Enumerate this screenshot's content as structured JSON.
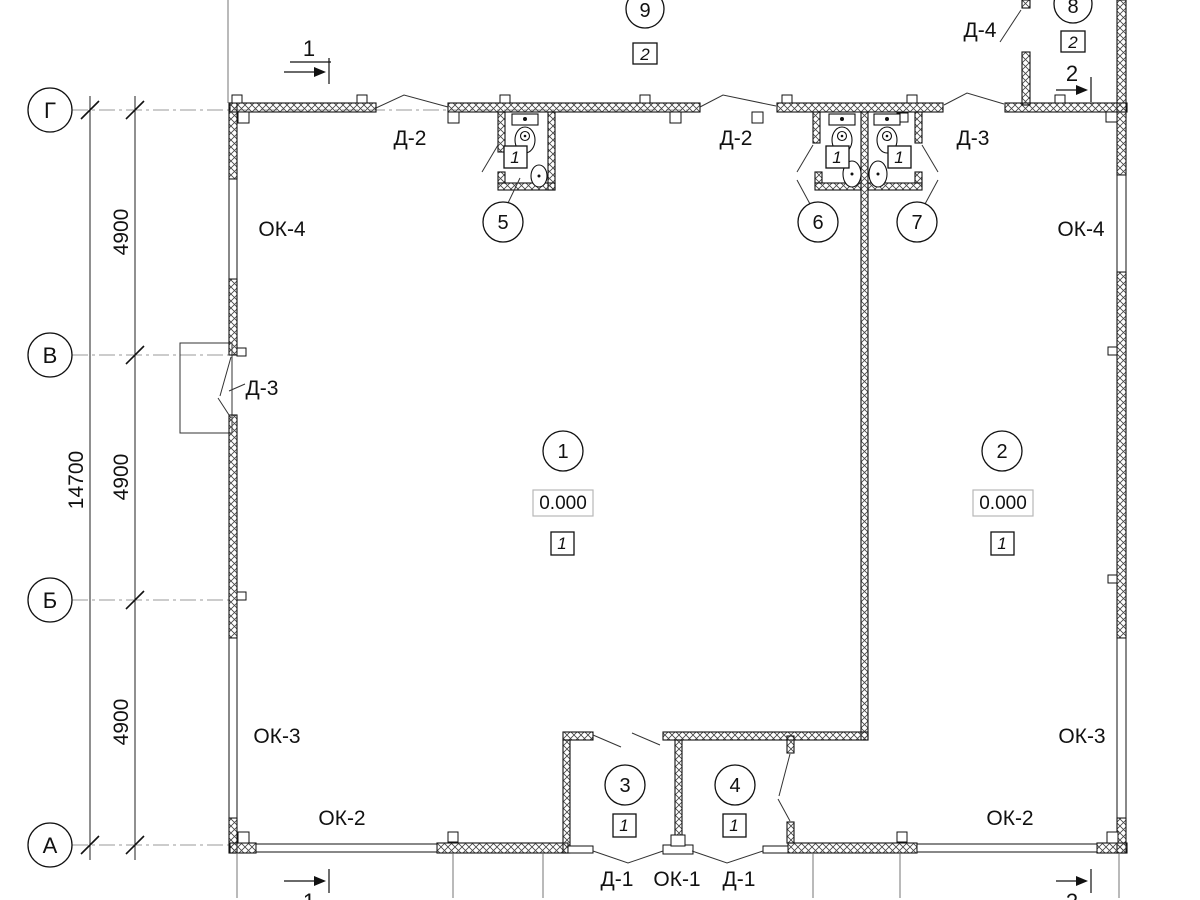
{
  "drawing_type": "floor-plan",
  "colors": {
    "ink": "#1a1a1a",
    "axis_line": "#999999",
    "elevation_box_border": "#b8b8b8"
  },
  "axes": {
    "g": "Г",
    "v": "В",
    "b": "Б",
    "a": "А"
  },
  "dims": {
    "total": "14700",
    "bays": [
      "4900",
      "4900",
      "4900"
    ]
  },
  "rooms": [
    {
      "number": "1",
      "finish": "1",
      "elevation": "0.000"
    },
    {
      "number": "2",
      "finish": "1",
      "elevation": "0.000"
    },
    {
      "number": "3",
      "finish": "1"
    },
    {
      "number": "4",
      "finish": "1"
    },
    {
      "number": "5",
      "finish": "1"
    },
    {
      "number": "6",
      "finish": "1"
    },
    {
      "number": "7",
      "finish": "1"
    },
    {
      "number": "8",
      "finish": "2"
    },
    {
      "number": "9",
      "finish": "2"
    }
  ],
  "tags": {
    "d1": "Д-1",
    "d2": "Д-2",
    "d3": "Д-3",
    "d4": "Д-4",
    "ok1": "ОК-1",
    "ok2": "ОК-2",
    "ok3": "ОК-3",
    "ok4": "ОК-4"
  },
  "sections": {
    "s1": "1",
    "s2": "2"
  }
}
